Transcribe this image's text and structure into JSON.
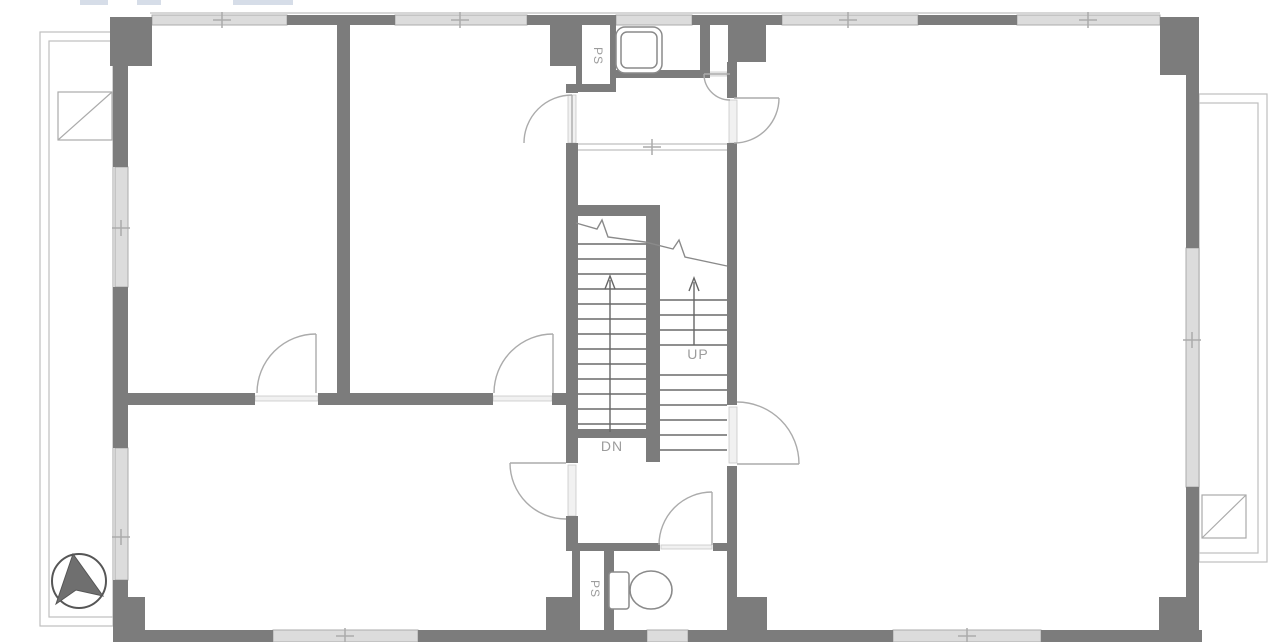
{
  "labels": {
    "ps_top": "PS",
    "ps_bottom": "PS",
    "up": "UP",
    "dn": "DN"
  },
  "colors": {
    "wall": "#7c7c7c",
    "window_fill": "#dcdcdc",
    "window_edge": "#ababab",
    "sill_fill": "#f1f1f1",
    "sill_edge": "#c9c9c9",
    "door": "#ababab",
    "stair": "#8f8f8f",
    "thin": "#bfbfbf",
    "break_line": "#8a8a8a",
    "arrow": "#666666",
    "fixture": "#8a8a8a",
    "north_fill": "#6f6f6f",
    "north_edge": "#565656",
    "text": "#9c9c9c",
    "top_mark": "#ccd4e2"
  },
  "plan": {
    "canvas": {
      "w": 1280,
      "h": 642
    },
    "walls": [
      [
        110,
        17,
        42,
        49
      ],
      [
        287,
        15,
        108,
        10
      ],
      [
        527,
        15,
        89,
        10
      ],
      [
        550,
        17,
        31,
        49
      ],
      [
        692,
        15,
        90,
        10
      ],
      [
        728,
        17,
        38,
        45
      ],
      [
        918,
        15,
        99,
        10
      ],
      [
        1160,
        17,
        39,
        58
      ],
      [
        113,
        17,
        15,
        150
      ],
      [
        113,
        287,
        15,
        161
      ],
      [
        113,
        580,
        15,
        62
      ],
      [
        113,
        597,
        32,
        45
      ],
      [
        1186,
        17,
        13,
        231
      ],
      [
        1186,
        487,
        13,
        155
      ],
      [
        1159,
        597,
        29,
        45
      ],
      [
        113,
        630,
        160,
        12
      ],
      [
        418,
        630,
        204,
        12
      ],
      [
        622,
        630,
        25,
        12
      ],
      [
        688,
        630,
        205,
        12
      ],
      [
        1041,
        630,
        161,
        12
      ],
      [
        546,
        597,
        27,
        45
      ],
      [
        727,
        597,
        40,
        45
      ],
      [
        337,
        24,
        13,
        369
      ],
      [
        113,
        393,
        142,
        12
      ],
      [
        318,
        393,
        175,
        12
      ],
      [
        552,
        393,
        26,
        12
      ],
      [
        576,
        24,
        6,
        60
      ],
      [
        610,
        24,
        6,
        60
      ],
      [
        576,
        84,
        40,
        8
      ],
      [
        700,
        24,
        10,
        54
      ],
      [
        614,
        70,
        86,
        8
      ],
      [
        566,
        84,
        12,
        9
      ],
      [
        566,
        143,
        12,
        320
      ],
      [
        566,
        516,
        12,
        35
      ],
      [
        727,
        62,
        10,
        36
      ],
      [
        727,
        143,
        10,
        262
      ],
      [
        727,
        466,
        10,
        131
      ],
      [
        566,
        543,
        94,
        8
      ],
      [
        713,
        543,
        24,
        8
      ],
      [
        572,
        551,
        8,
        79
      ],
      [
        604,
        551,
        10,
        79
      ],
      [
        575,
        205,
        85,
        11
      ],
      [
        646,
        205,
        14,
        257
      ],
      [
        572,
        429,
        88,
        9
      ]
    ],
    "windows": [
      [
        152,
        15,
        135,
        10
      ],
      [
        395,
        15,
        132,
        10
      ],
      [
        616,
        15,
        76,
        10
      ],
      [
        782,
        15,
        136,
        10
      ],
      [
        1017,
        15,
        143,
        10
      ],
      [
        115,
        167,
        13,
        120
      ],
      [
        115,
        448,
        13,
        132
      ],
      [
        1186,
        248,
        13,
        239
      ],
      [
        273,
        630,
        145,
        12
      ],
      [
        893,
        630,
        148,
        12
      ],
      [
        647,
        630,
        41,
        12
      ]
    ],
    "sills": [
      [
        255,
        396,
        63,
        5
      ],
      [
        493,
        396,
        59,
        5
      ],
      [
        568,
        95,
        8,
        48
      ],
      [
        729,
        100,
        8,
        43
      ],
      [
        729,
        407,
        8,
        56
      ],
      [
        568,
        465,
        8,
        51
      ],
      [
        706,
        72,
        21,
        4
      ],
      [
        661,
        545,
        51,
        4
      ]
    ],
    "thin_rects": [
      [
        40,
        32,
        73,
        594
      ],
      [
        49,
        41,
        64,
        576
      ],
      [
        1199,
        94,
        68,
        468
      ],
      [
        1199,
        103,
        59,
        450
      ]
    ],
    "squares": [
      {
        "x": 58,
        "y": 92,
        "w": 54,
        "h": 48
      },
      {
        "x": 1202,
        "y": 495,
        "w": 44,
        "h": 43
      }
    ],
    "thin_lines": [
      [
        150,
        13,
        1160,
        13
      ],
      [
        578,
        144,
        727,
        144
      ],
      [
        578,
        150,
        727,
        150
      ]
    ],
    "steps": [
      {
        "x1": 578,
        "x2": 646,
        "ys": [
          244,
          259,
          274,
          289,
          304,
          319,
          334,
          349,
          364,
          379,
          394,
          409,
          424
        ]
      },
      {
        "x1": 660,
        "x2": 727,
        "ys": [
          300,
          315,
          330,
          345,
          375,
          390,
          405,
          420,
          435,
          450
        ]
      }
    ],
    "break_path": "M576,223 L597,229 L602,220 L608,237 L645,242 L673,249 L679,240 L685,257 L727,266",
    "door_arcs": [
      {
        "p": "M316,334 A59,59 0 0 0 257,393",
        "leaf": [
          316,
          334,
          316,
          393
        ]
      },
      {
        "p": "M553,334 A59,59 0 0 0 494,393",
        "leaf": [
          553,
          334,
          553,
          393
        ]
      },
      {
        "p": "M572,95 A48,48 0 0 0 524,143",
        "leaf": [
          572,
          95,
          572,
          143
        ]
      },
      {
        "p": "M779,98 A45,45 0 0 1 734,143",
        "leaf": [
          734,
          98,
          779,
          98
        ]
      },
      {
        "p": "M704,74 A26,26 0 0 0 730,100",
        "leaf": [
          704,
          74,
          730,
          74
        ]
      },
      {
        "p": "M799,464 A62,62 0 0 0 737,402",
        "leaf": [
          737,
          464,
          799,
          464
        ]
      },
      {
        "p": "M510,463 A56,56 0 0 0 566,519",
        "leaf": [
          510,
          463,
          566,
          463
        ]
      },
      {
        "p": "M712,492 A53,53 0 0 0 659,545",
        "leaf": [
          712,
          492,
          712,
          545
        ]
      }
    ],
    "arrows": [
      {
        "x": 694,
        "tip": 278,
        "tail": 345
      },
      {
        "x": 610,
        "tip": 276,
        "tail": 432
      }
    ],
    "ticks": [
      {
        "x": 222,
        "y": 20
      },
      {
        "x": 460,
        "y": 20
      },
      {
        "x": 848,
        "y": 20
      },
      {
        "x": 1088,
        "y": 20
      },
      {
        "x": 121,
        "y": 228
      },
      {
        "x": 121,
        "y": 537
      },
      {
        "x": 1192,
        "y": 340
      },
      {
        "x": 345,
        "y": 636
      },
      {
        "x": 967,
        "y": 636
      },
      {
        "x": 652,
        "y": 147
      }
    ],
    "rounded_rects": [
      {
        "x": 616,
        "y": 27,
        "w": 46,
        "h": 46,
        "rx": 9
      },
      {
        "x": 621,
        "y": 32,
        "w": 36,
        "h": 36,
        "rx": 6
      },
      {
        "x": 609,
        "y": 572,
        "w": 20,
        "h": 37,
        "rx": 3
      }
    ],
    "ellipses": [
      {
        "cx": 651,
        "cy": 590,
        "rx": 21,
        "ry": 19
      }
    ],
    "north": {
      "cx": 79,
      "cy": 581,
      "r": 27,
      "pts": "73,554 56,604 76,590 103,596"
    },
    "top_marks": [
      {
        "x": 80,
        "w": 28
      },
      {
        "x": 137,
        "w": 24
      },
      {
        "x": 233,
        "w": 60
      }
    ]
  }
}
